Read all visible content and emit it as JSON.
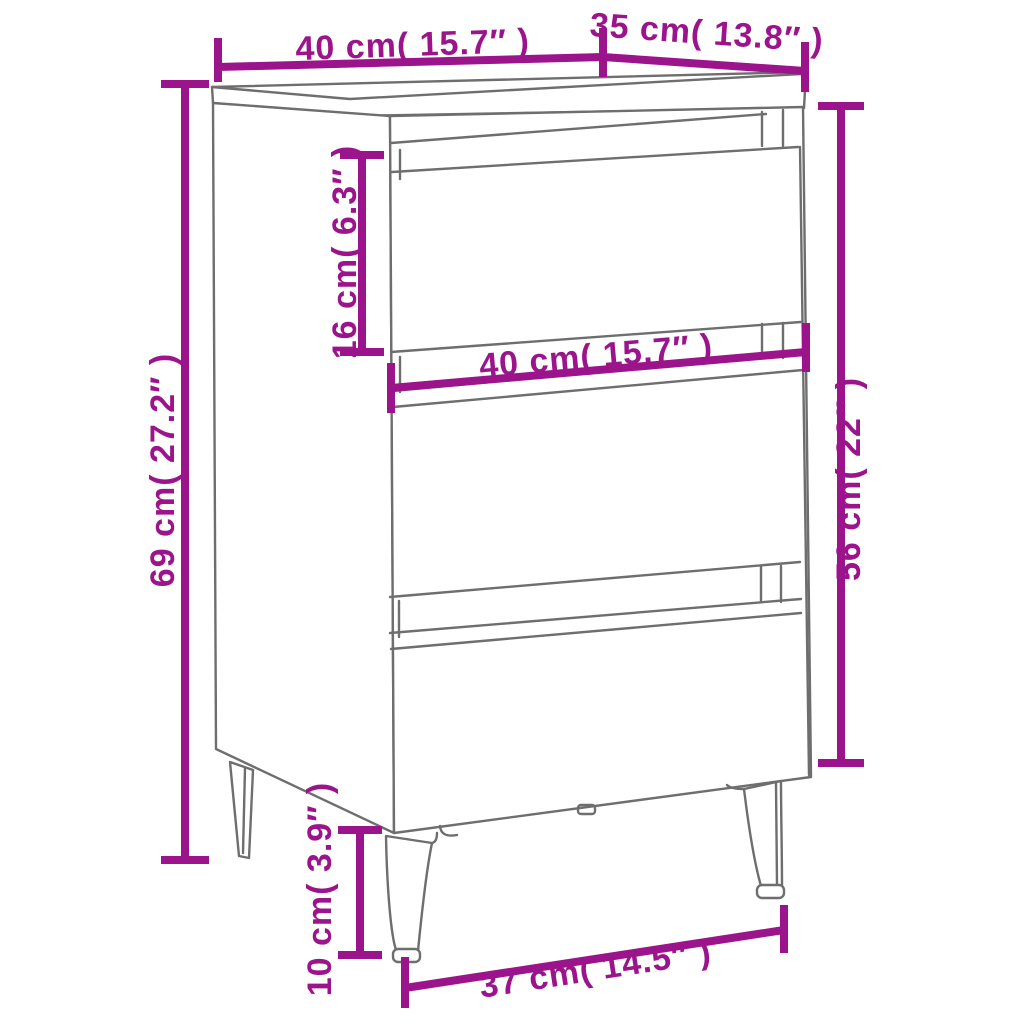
{
  "meta": {
    "title": "Bedside cabinet dimension diagram",
    "product": "Bedside cabinet with 3 drawers and metal legs",
    "view": "perspective line drawing with dimension annotations"
  },
  "colors": {
    "accent": "#9B148C",
    "outline": "#6E6E6E",
    "background": "#FFFFFF"
  },
  "dimensions": {
    "top_width": "40 cm( 15.7″ )",
    "top_depth": "35 cm( 13.8″ )",
    "total_height": "69 cm( 27.2″ )",
    "top_drawer_height": "16 cm( 6.3″ )",
    "middle_drawer_width": "40 cm( 15.7″ )",
    "body_height": "56 cm( 22″ )",
    "leg_height": "10 cm( 3.9″ )",
    "leg_footprint_width": "37 cm( 14.5″ )"
  }
}
